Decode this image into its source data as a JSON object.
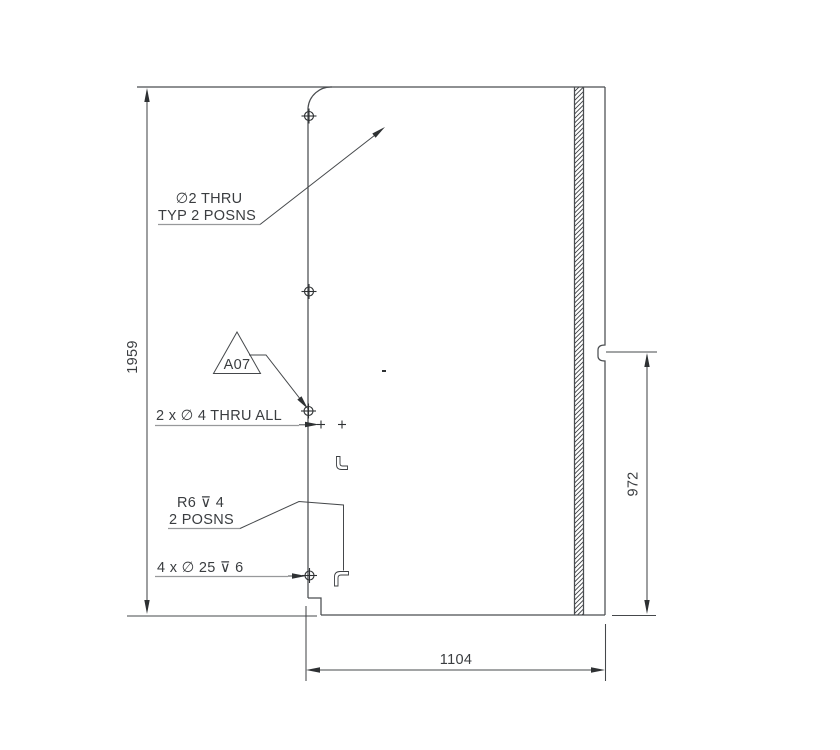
{
  "drawing": {
    "dimensions": {
      "overall_height": "1959",
      "right_edge_height": "972",
      "overall_width": "1104"
    },
    "notes": {
      "small_hole_note_line1": "∅2 THRU",
      "small_hole_note_line2": "TYP 2 POSNS",
      "datum_flag_label": "A07",
      "thru_hole_note": "2 x ∅ 4 THRU ALL",
      "radius_note_line1": "R6 ⊽ 4",
      "radius_note_line2": "2 POSNS",
      "counterbore_note": "4 x ∅ 25 ⊽ 6"
    },
    "colors": {
      "line": "#4a4d50",
      "dimension_line": "#45484b",
      "light_leader_line": "#97999b",
      "text": "#3a3d40",
      "background": "#ffffff"
    }
  }
}
